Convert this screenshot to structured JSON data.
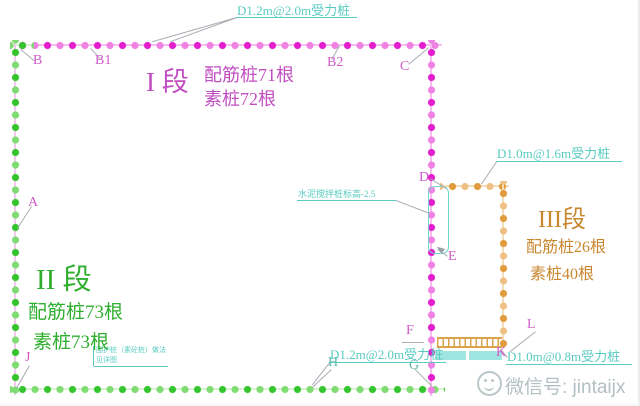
{
  "sections": [
    {
      "label": "I 段",
      "reinforced": "配筋桩71根",
      "plain": "素桩72根",
      "color": "#c14ec1"
    },
    {
      "label": "II 段",
      "reinforced": "配筋桩73根",
      "plain": "素桩73根",
      "color": "#2fae2f"
    },
    {
      "label": "III段",
      "reinforced": "配筋桩26根",
      "plain": "素桩40根",
      "color": "#c8872f"
    }
  ],
  "pile_callouts": [
    {
      "id": "top",
      "text": "D1.2m@2.0m受力桩"
    },
    {
      "id": "right",
      "text": "D1.0m@1.6m受力桩"
    },
    {
      "id": "bottom-left",
      "text": "D1.2m@2.0m受力桩"
    },
    {
      "id": "bottom-right",
      "text": "D1.0m@0.8m受力桩"
    }
  ],
  "notes": {
    "elevation": "水泥搅拌桩标高-2.5",
    "corner_line1": "围护桩（素砼桩）做法",
    "corner_line2": "见详图"
  },
  "points": {
    "A": "A",
    "B": "B",
    "B1": "B1",
    "B2": "B2",
    "C": "C",
    "D": "D",
    "E": "E",
    "F": "F",
    "G": "G",
    "H": "H",
    "J": "J",
    "K": "K",
    "L": "L"
  },
  "watermark": {
    "icon": "wechat",
    "text": "微信号: jintaijx"
  },
  "colors": {
    "wall_section1": "#e31ece",
    "wall_section2": "#35c42d",
    "wall_section3": "#e09b3d",
    "callout_cyan": "#58cbc2",
    "point_label": "#cf5ccb"
  }
}
